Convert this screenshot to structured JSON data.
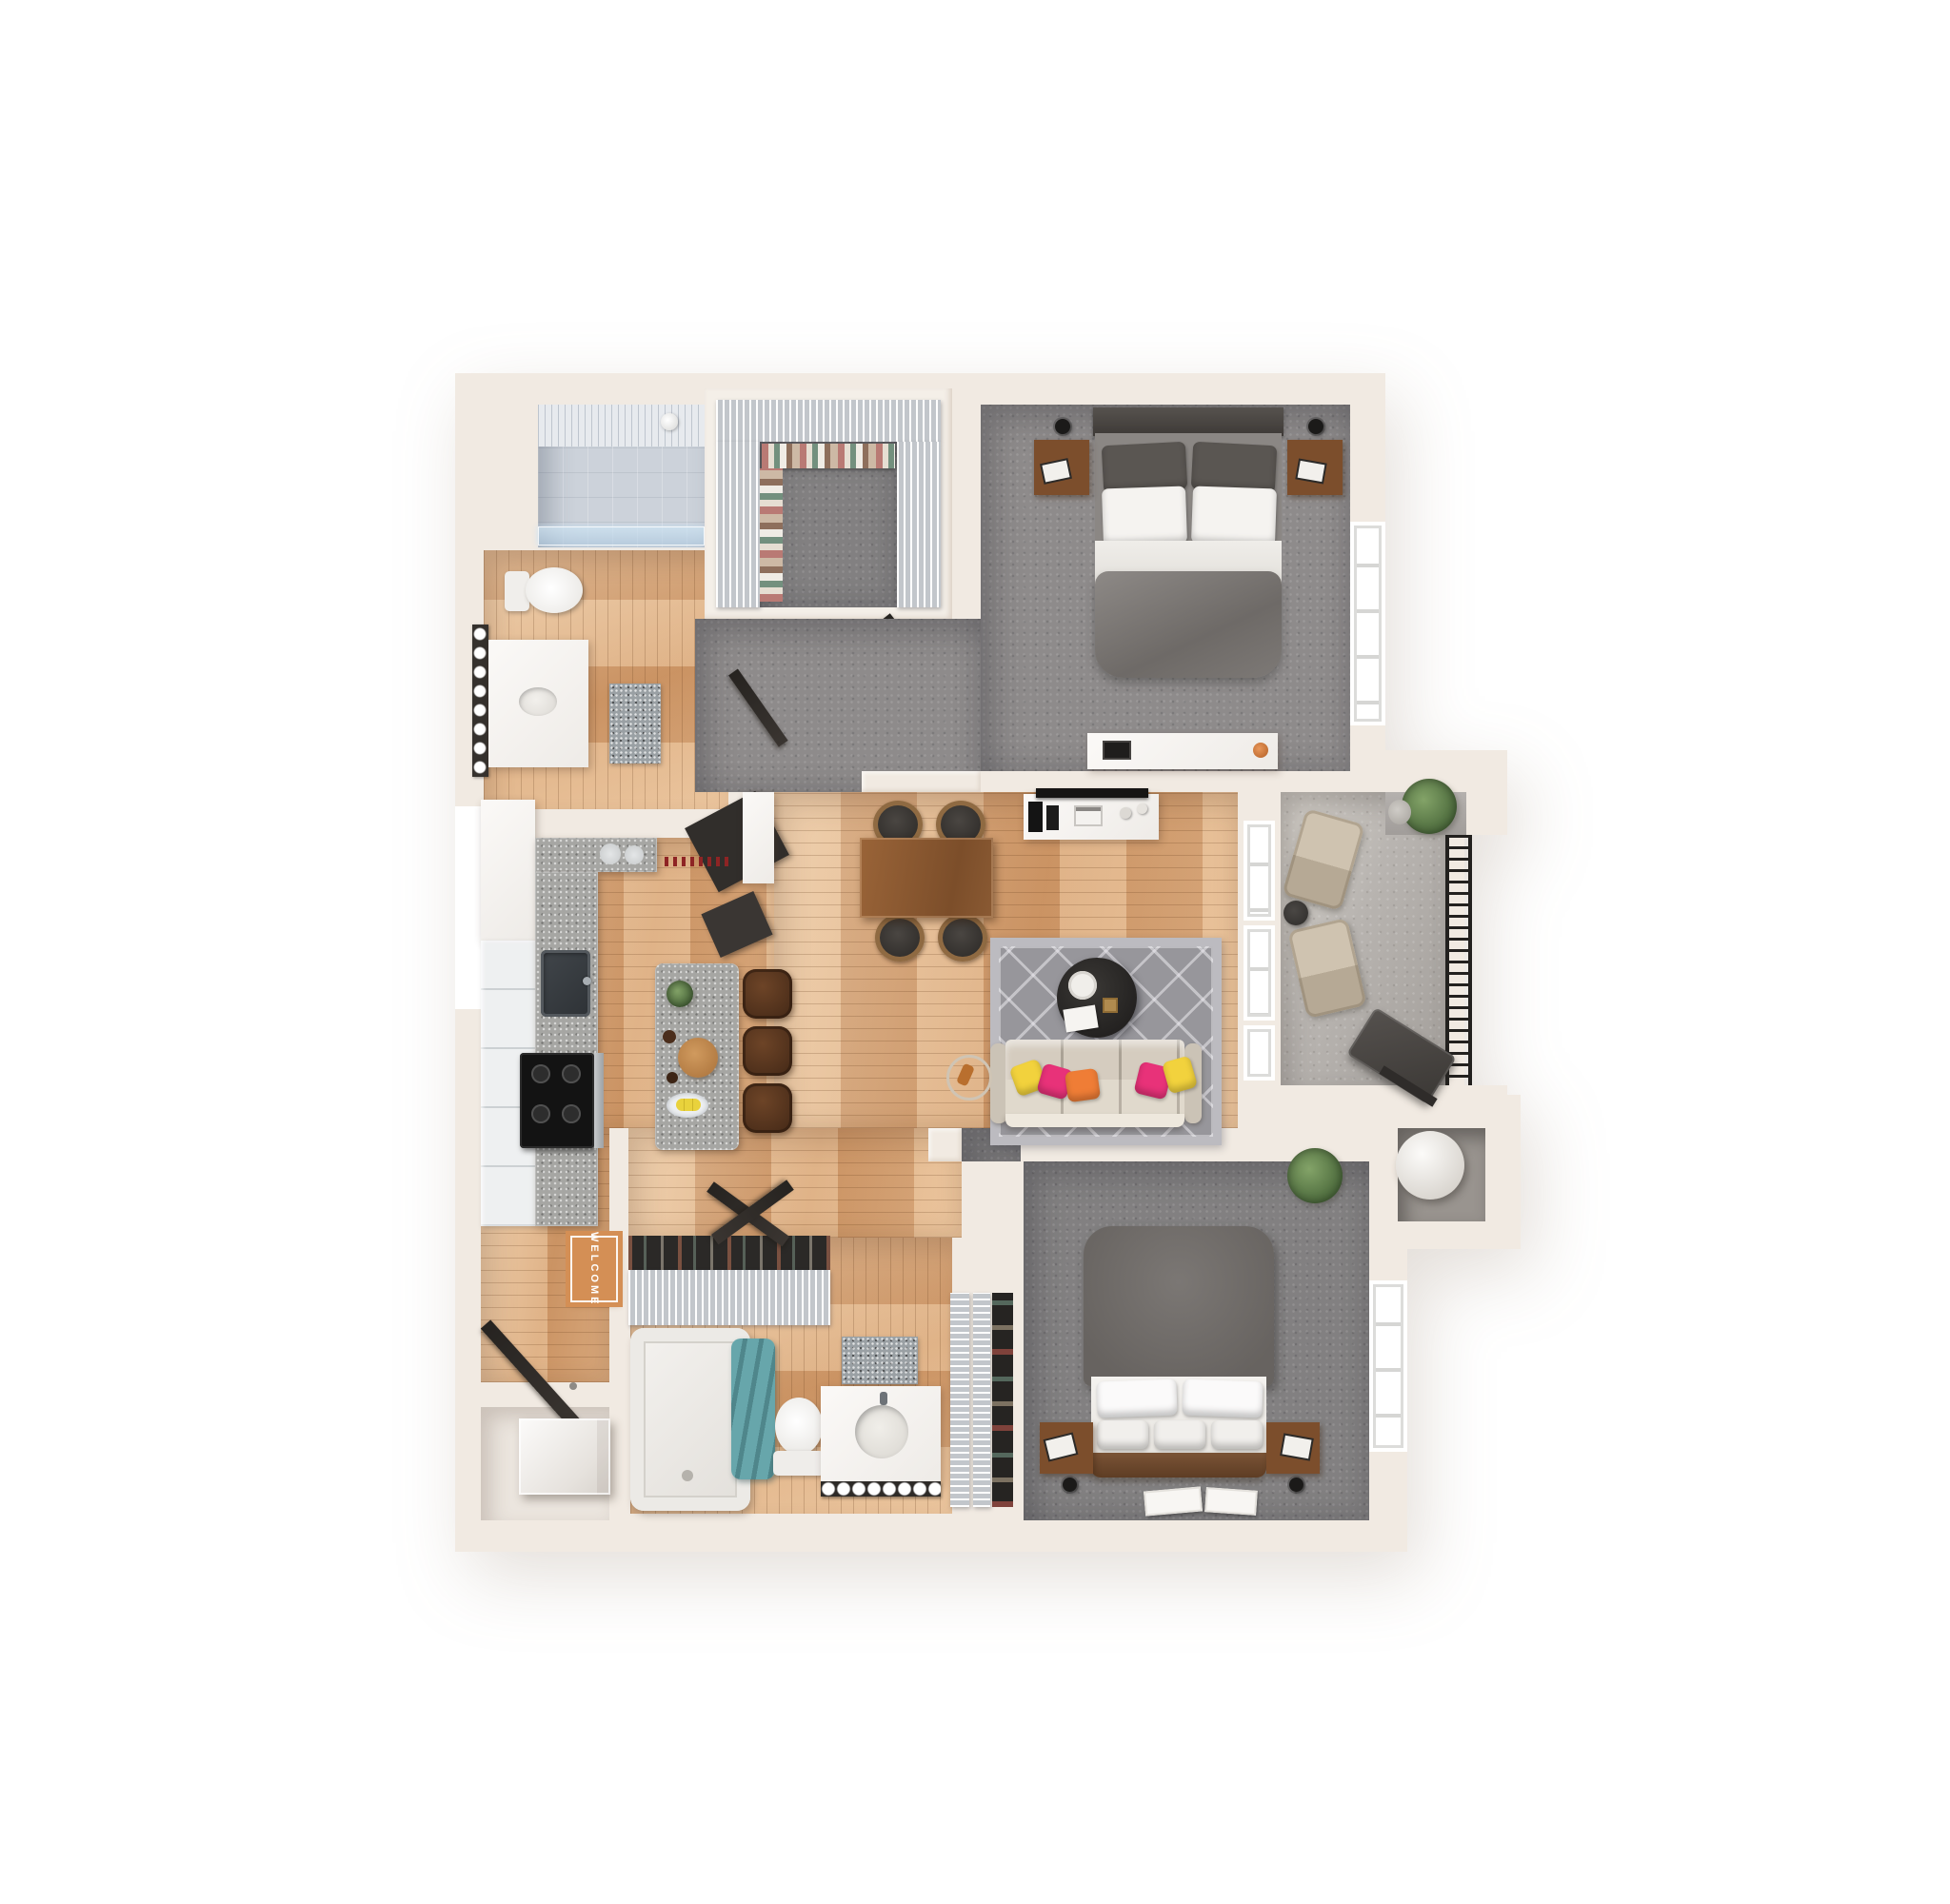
{
  "scene": {
    "description": "3D rendered top-down floor plan of a two-bedroom, two-bath apartment with balcony",
    "view": "top-down dollhouse render",
    "background_color": "#ffffff"
  },
  "text": {
    "welcome_mat": "WELCOME"
  },
  "palette": {
    "wall": "#f1eae2",
    "wallShade": "#e2d6c9",
    "white": "#f7f5f2",
    "wood": "#d7a173",
    "woodDark": "#b97f4e",
    "carpet": "#8e8b8b",
    "tile": "#ccd2da",
    "concrete": "#b8b4b0",
    "granite": "#a6a6a3",
    "marble": "#9aa0a4",
    "sofa": "#d5ccbf",
    "rug": "#97969b",
    "rugBorder": "#bcbbc0",
    "tableWood": "#8a5833",
    "stool": "#5d3a24",
    "mat": "#d48f55",
    "teal": "#67a6ab",
    "plant": "#5d7a4c",
    "dark": "#312e2b",
    "accentYellow": "#f2d23d",
    "accentPink": "#e83279",
    "accentOrange": "#ef7d36",
    "bedGray": "#7c7875",
    "headboard": "#45413e",
    "nightstand": "#7c4e2c",
    "railing": "#23211f"
  },
  "rooms": [
    {
      "id": "shower-room",
      "floor": "tile"
    },
    {
      "id": "primary-bathroom",
      "floor": "wood"
    },
    {
      "id": "walk-in-closet",
      "floor": "carpet"
    },
    {
      "id": "primary-bedroom",
      "floor": "carpet"
    },
    {
      "id": "vestibule-hall",
      "floor": "carpet"
    },
    {
      "id": "living-room",
      "floor": "wood"
    },
    {
      "id": "dining-area",
      "floor": "wood"
    },
    {
      "id": "kitchen",
      "floor": "wood"
    },
    {
      "id": "entry",
      "floor": "wood"
    },
    {
      "id": "laundry-closet",
      "floor": "pale"
    },
    {
      "id": "hall-closet",
      "floor": "wood"
    },
    {
      "id": "second-bathroom",
      "floor": "wood"
    },
    {
      "id": "linen-closet",
      "floor": "wood"
    },
    {
      "id": "second-bedroom",
      "floor": "carpet"
    },
    {
      "id": "balcony",
      "floor": "concrete"
    },
    {
      "id": "storage-closet",
      "floor": "concrete"
    }
  ],
  "furniture": [
    "glass-shower",
    "toilet",
    "vanity-with-mirror-lights",
    "bath-rug",
    "wire-closet-shelving",
    "hanging-clothes",
    "queen-bed",
    "nightstands-with-lamps",
    "bedroom-dresser-desk",
    "media-console-tv",
    "cream-sofa",
    "accent-pillows",
    "round-coffee-table",
    "geometric-area-rug",
    "dining-table-four-chairs",
    "kitchen-island",
    "bar-stools",
    "range-cooktop",
    "kitchen-sink",
    "cabinets",
    "welcome-mat",
    "entry-door",
    "washer",
    "bathtub-shower",
    "teal-towels",
    "second-vanity",
    "second-toilet",
    "shoe-closet",
    "second-queen-bed",
    "floor-art-cards",
    "potted-plants",
    "balcony-lounge-chairs",
    "balcony-grill",
    "balcony-railing",
    "water-heater"
  ]
}
